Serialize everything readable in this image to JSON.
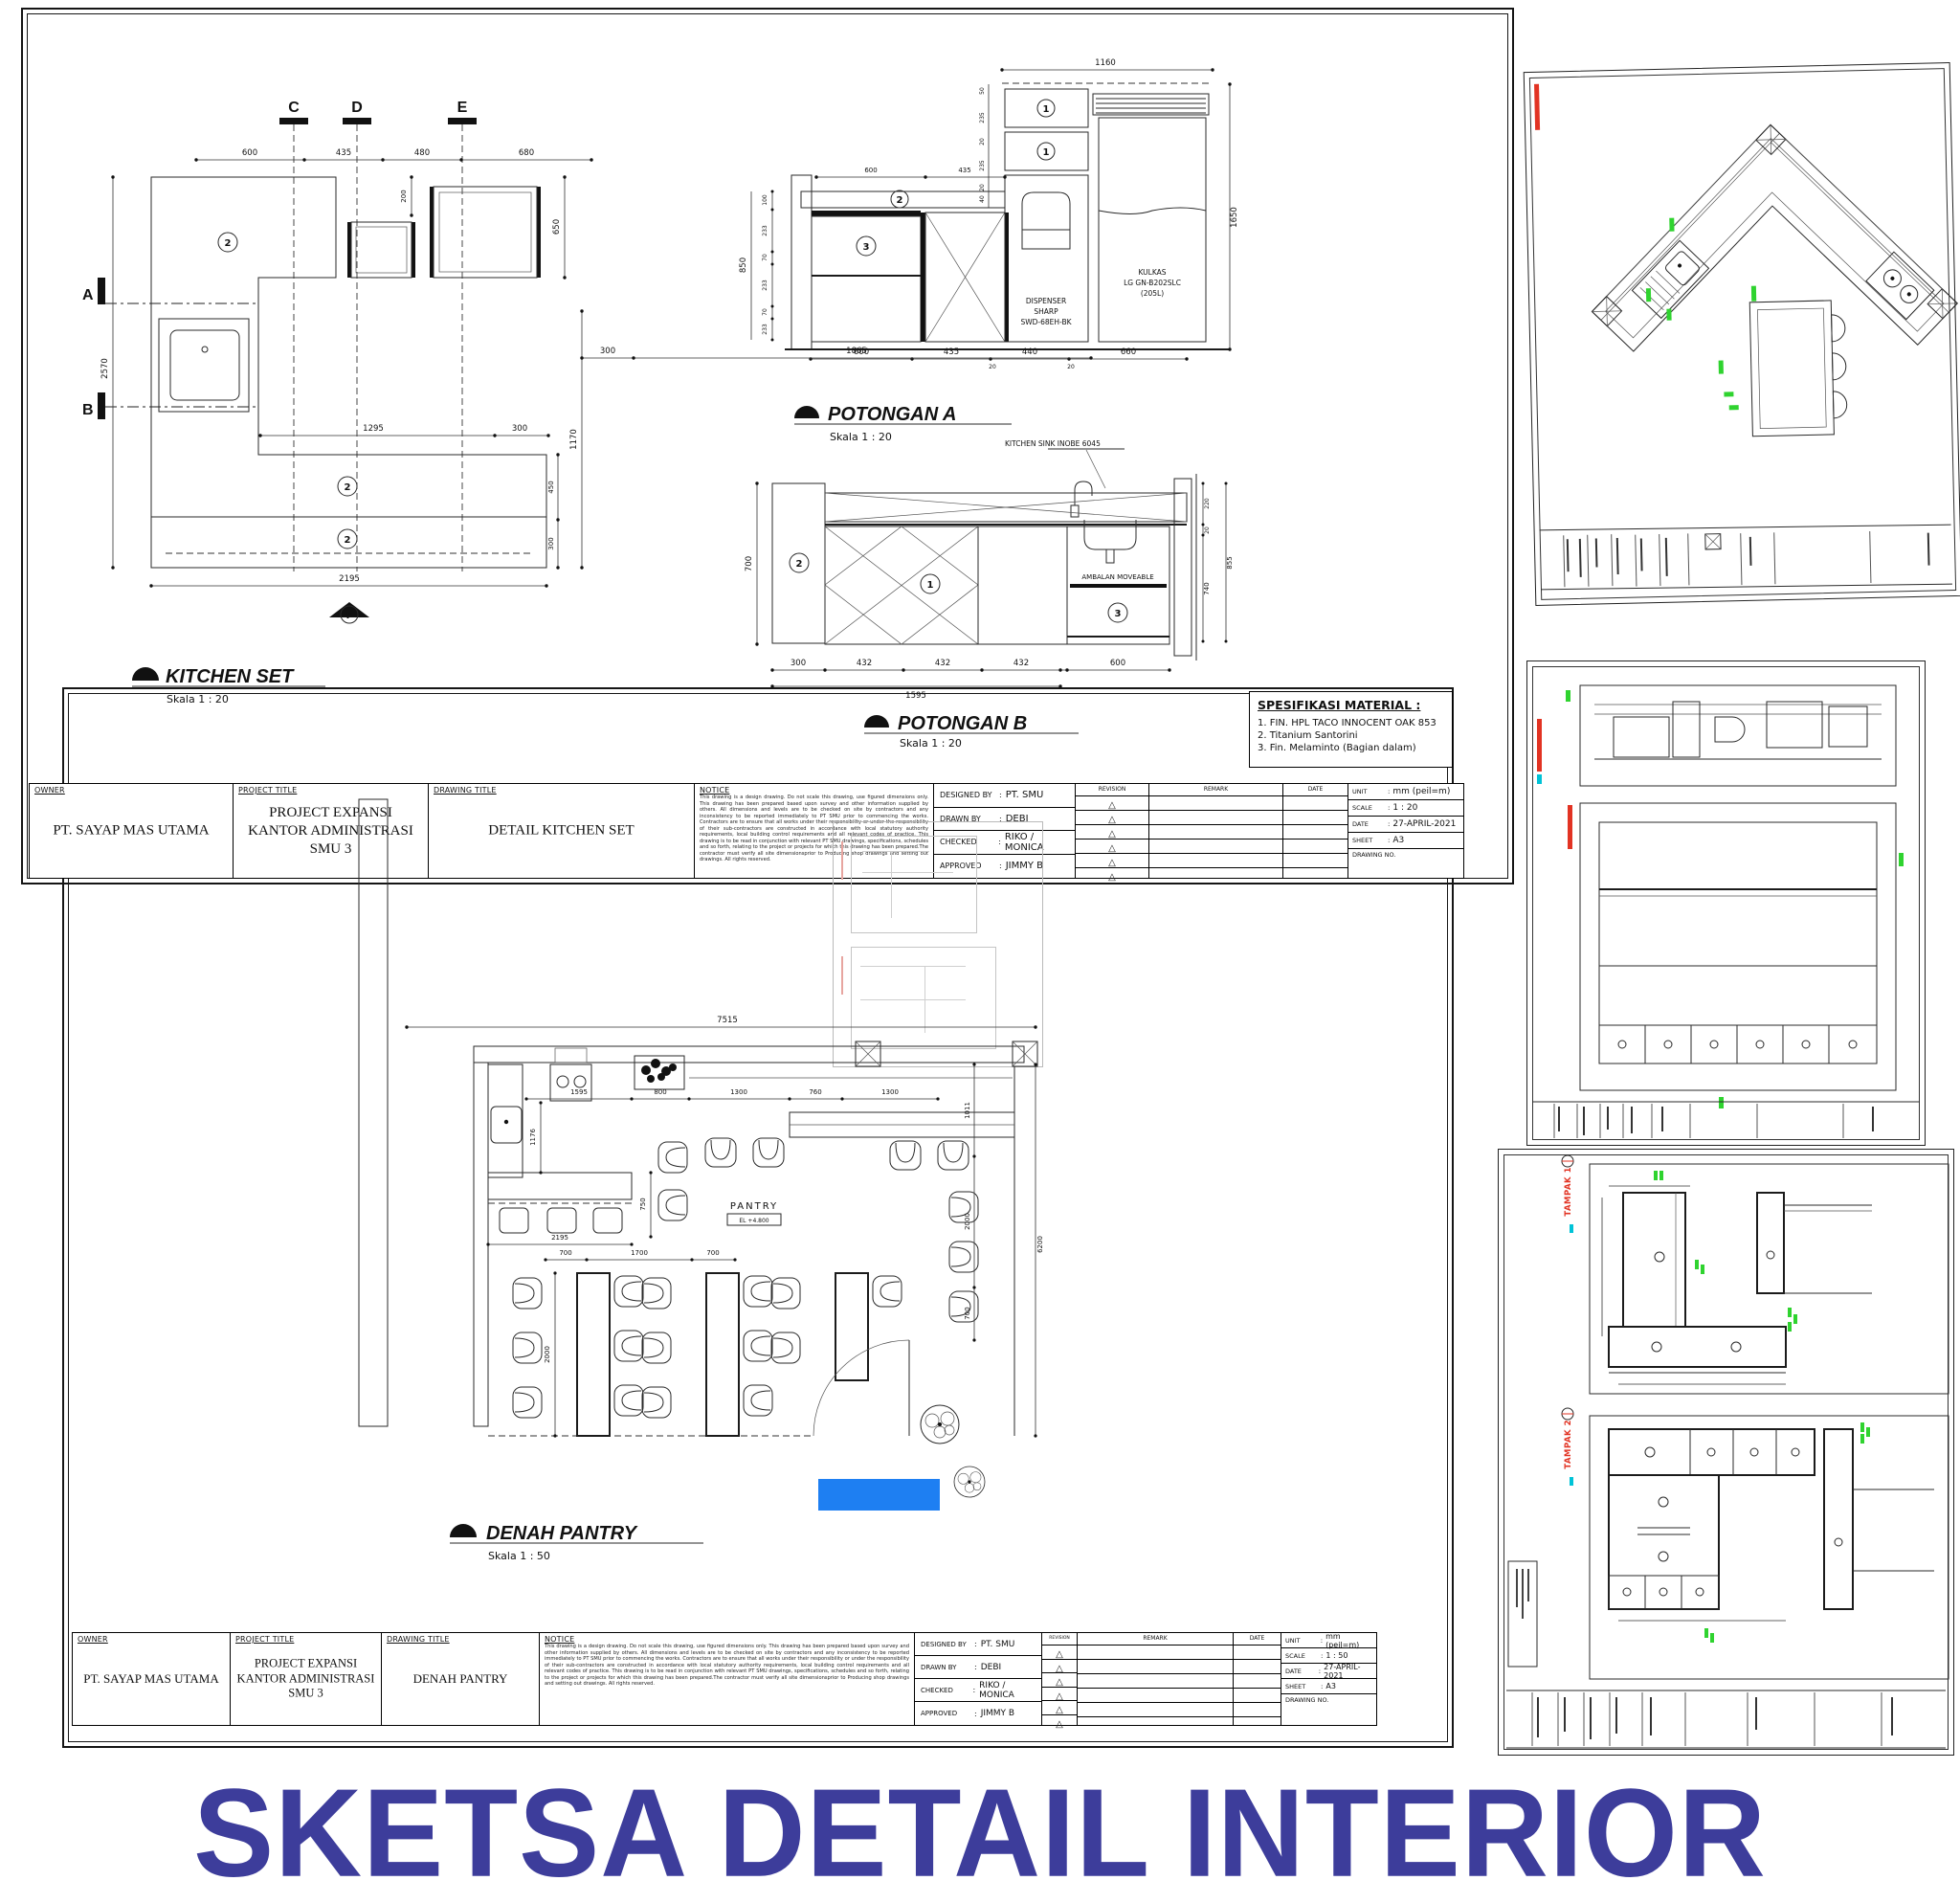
{
  "page": {
    "main_title": "SKETSA DETAIL INTERIOR",
    "colors": {
      "title": "#3d3d9b",
      "annotation_red": "#e23323",
      "annotation_green": "#2fd32f",
      "annotation_cyan": "#00c3d7",
      "highlight_blue": "#1e7ff2"
    }
  },
  "labels": {
    "owner": "OWNER",
    "project_title": "PROJECT TITLE",
    "drawing_title": "DRAWING TITLE",
    "notice": "NOTICE",
    "revision": "REVISION",
    "remark": "REMARK",
    "date": "DATE",
    "designed_by": "DESIGNED BY",
    "drawn_by": "DRAWN BY",
    "checked": "CHECKED",
    "approved": "APPROVED",
    "unit": "UNIT",
    "scale": "SCALE",
    "sheet": "SHEET",
    "drawing_no": "DRAWING NO.",
    "colon": ":"
  },
  "notice_text": "This drawing is a design drawing. Do not scale this drawing, use figured dimensions only. This drawing has been prepared based upon survey and other information supplied by others. All dimensions and levels are to be checked on site by contractors and any inconsistency to be reported immediately to PT SMU prior to commencing the works. Contractors are to ensure that all works under their responsibility or under the responsibility of their sub-contractors are constructed in accordance with local statutory authority requirements, local building control requirements and all relevant codes of practice. This drawing is to be read in conjunction with relevant PT SMU drawings, specifications, schedules and so forth, relating to the project or projects for which this drawing has been prepared.The contractor must verify all site dimensionsprior to Producing shop drawings and setting out drawings. All rights reserved.",
  "kitchen_sheet": {
    "owner": "PT. SAYAP MAS UTAMA",
    "project_line1": "PROJECT EXPANSI",
    "project_line2": "KANTOR ADMINISTRASI SMU 3",
    "drawing": "DETAIL KITCHEN SET",
    "designed": "PT. SMU",
    "drawn": "DEBI",
    "checked": "RIKO / MONICA",
    "approved": "JIMMY B",
    "unit": "mm (peil=m)",
    "scale": "1 : 20",
    "date": "27-APRIL-2021",
    "sheet": "A3"
  },
  "pantry_sheet": {
    "owner": "PT. SAYAP MAS UTAMA",
    "project_line1": "PROJECT EXPANSI",
    "project_line2": "KANTOR ADMINISTRASI SMU 3",
    "drawing": "DENAH PANTRY",
    "designed": "PT. SMU",
    "drawn": "DEBI",
    "checked": "RIKO / MONICA",
    "approved": "JIMMY B",
    "unit": "mm (peil=m)",
    "scale": "1 : 50",
    "date": "27-APRIL-2021",
    "sheet": "A3"
  },
  "spesifikasi": {
    "title": "SPESIFIKASI MATERIAL :",
    "item1": "1. FIN. HPL TACO INNOCENT OAK 853",
    "item2": "2. Titanium Santorini",
    "item3": "3. Fin. Melaminto (Bagian dalam)"
  },
  "kitchen_plan": {
    "title": "KITCHEN SET",
    "scale_label": "Skala 1 : 20",
    "marker_a": "A",
    "marker_b": "B",
    "marker_c": "C",
    "marker_d": "D",
    "marker_e": "E",
    "marker_f": "F",
    "m2": "2",
    "d600": "600",
    "d435": "435",
    "d480": "480",
    "d680": "680",
    "d200": "200",
    "d650": "650",
    "d2570": "2570",
    "d1170": "1170",
    "d1295": "1295",
    "d300a": "300",
    "d450": "450",
    "d300b": "300",
    "d2195": "2195"
  },
  "potongan_a": {
    "title": "POTONGAN A",
    "scale_label": "Skala 1 : 20",
    "m1": "1",
    "m1b": "1",
    "m2": "2",
    "m3": "3",
    "dispenser1": "DISPENSER",
    "dispenser2": "SHARP",
    "dispenser3": "SWD-68EH-BK",
    "kulkas1": "KULKAS",
    "kulkas2": "LG GN-B202SLC",
    "kulkas3": "(205L)",
    "d1160": "1160",
    "d850": "850",
    "d100": "100",
    "d233a": "233",
    "d70a": "70",
    "d233b": "233",
    "d70b": "70",
    "d233c": "233",
    "d1650": "1650",
    "d50": "50",
    "d235a": "235",
    "d20a": "20",
    "d235b": "235",
    "d20b": "20",
    "d40": "40",
    "d600": "600",
    "d435": "435",
    "d440": "440",
    "d660": "660",
    "d20c": "20",
    "d20d": "20"
  },
  "potongan_b": {
    "title": "POTONGAN B",
    "scale_label": "Skala 1 : 20",
    "sink_label": "KITCHEN SINK INOBE 6045",
    "ambalan": "AMBALAN MOVEABLE",
    "m1": "1",
    "m2": "2",
    "m3": "3",
    "d300t": "300",
    "d1865": "1865",
    "d700": "700",
    "d220": "220",
    "d20": "20",
    "d740": "740",
    "d855": "855",
    "d300": "300",
    "d432a": "432",
    "d432b": "432",
    "d432c": "432",
    "d600": "600",
    "d1595": "1595"
  },
  "pantry_plan": {
    "title": "DENAH PANTRY",
    "scale_label": "Skala 1 : 50",
    "room": "PANTRY",
    "level": "EL +4.800",
    "d7515": "7515",
    "d1595": "1595",
    "d800": "800",
    "d1300a": "1300",
    "d760": "760",
    "d1300b": "1300",
    "d1176": "1176",
    "d750": "750",
    "d2195": "2195",
    "d700a": "700",
    "d1700": "1700",
    "d700b": "700",
    "d2000a": "2000",
    "d6200": "6200",
    "d1011": "1011",
    "d2000b": "2000",
    "d700c": "700"
  },
  "right_sheets": {
    "tampak1": "TAMPAK 1",
    "tampak2": "TAMPAK 2"
  }
}
